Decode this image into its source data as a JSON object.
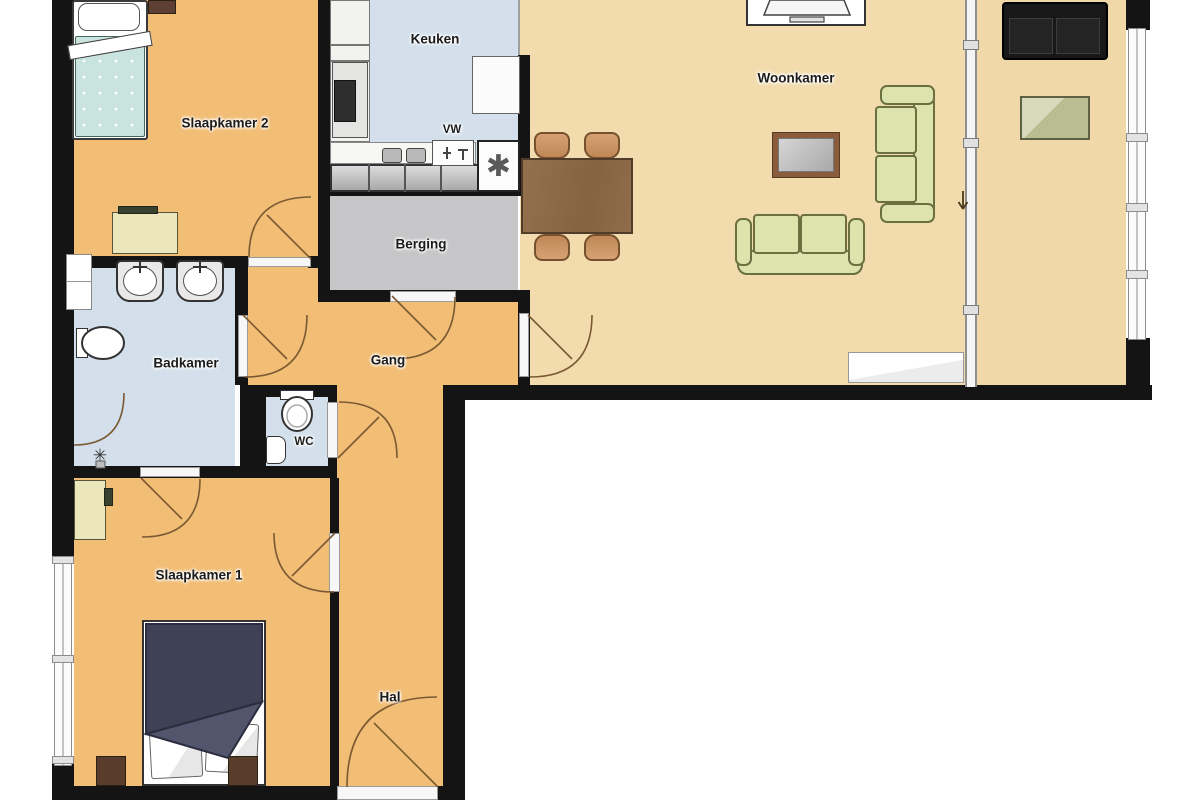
{
  "rooms": {
    "slaapkamer2": {
      "label": "Slaapkamer 2"
    },
    "keuken": {
      "label": "Keuken"
    },
    "woonkamer": {
      "label": "Woonkamer"
    },
    "berging": {
      "label": "Berging"
    },
    "badkamer": {
      "label": "Badkamer"
    },
    "gang": {
      "label": "Gang"
    },
    "wc": {
      "label": "WC"
    },
    "slaapkamer1": {
      "label": "Slaapkamer 1"
    },
    "hal": {
      "label": "Hal"
    }
  },
  "annotations": {
    "dishwasher": {
      "label": "VW"
    }
  },
  "symbols": {
    "washer_connection": "✱",
    "shower_head": "✳"
  },
  "colors": {
    "wall": "#141414",
    "floor_bedrooms_hall": "#f2bd74",
    "floor_living": "#f2dcae",
    "floor_wet_rooms": "#d3e0ec",
    "floor_storage": "#c6c6c8",
    "door_swing": "#7b5a33",
    "sofa_green": "#dce3ac",
    "bed_teal": "#c9e4de",
    "bed_navy": "#3f4156",
    "furniture_wood": "#8c6a4a"
  }
}
